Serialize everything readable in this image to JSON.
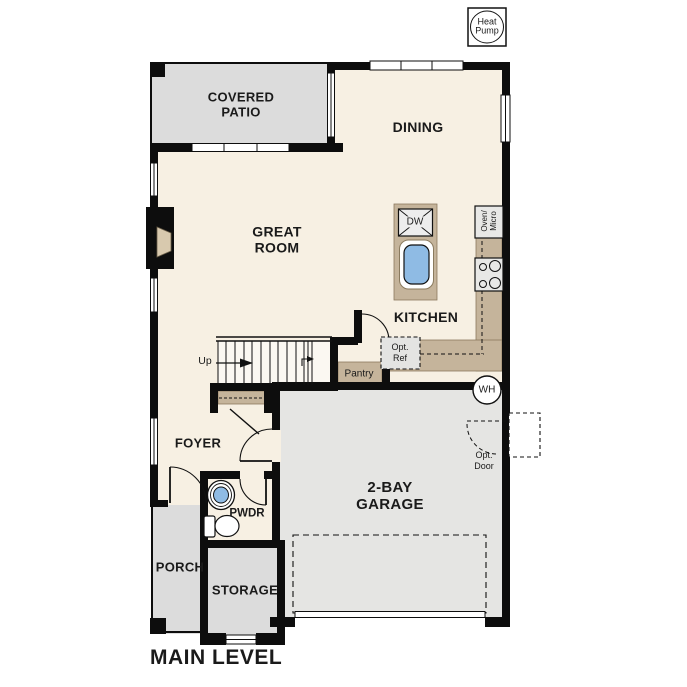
{
  "title": "MAIN LEVEL",
  "equipment": {
    "heat_pump": {
      "line1": "Heat",
      "line2": "Pump"
    },
    "water_heater": "WH"
  },
  "rooms": {
    "covered_patio": {
      "line1": "COVERED",
      "line2": "PATIO"
    },
    "dining": {
      "label": "DINING"
    },
    "great_room": {
      "line1": "GREAT",
      "line2": "ROOM"
    },
    "kitchen": {
      "label": "KITCHEN"
    },
    "pantry": {
      "label": "Pantry"
    },
    "foyer": {
      "label": "FOYER"
    },
    "powder": {
      "label": "PWDR"
    },
    "garage": {
      "line1": "2-BAY",
      "line2": "GARAGE"
    },
    "porch": {
      "label": "PORCH"
    },
    "storage": {
      "label": "STORAGE"
    }
  },
  "annotations": {
    "stairs_up": "Up",
    "dishwasher": "DW",
    "oven_micro": {
      "line1": "Oven/",
      "line2": "Micro"
    },
    "optional_refrigerator": {
      "line1": "Opt.",
      "line2": "Ref"
    },
    "optional_door": {
      "line1": "Opt.",
      "line2": "Door"
    }
  },
  "colors": {
    "interior_cream": "#f7f0e3",
    "patio_porch_gray": "#dcdcdc",
    "garage_gray": "#e5e5e3",
    "counter_tan": "#c5b49b",
    "fireplace_tan": "#d8c9ae",
    "sink_blue": "#8fbbe4",
    "wall_black": "#0d0d0d"
  }
}
